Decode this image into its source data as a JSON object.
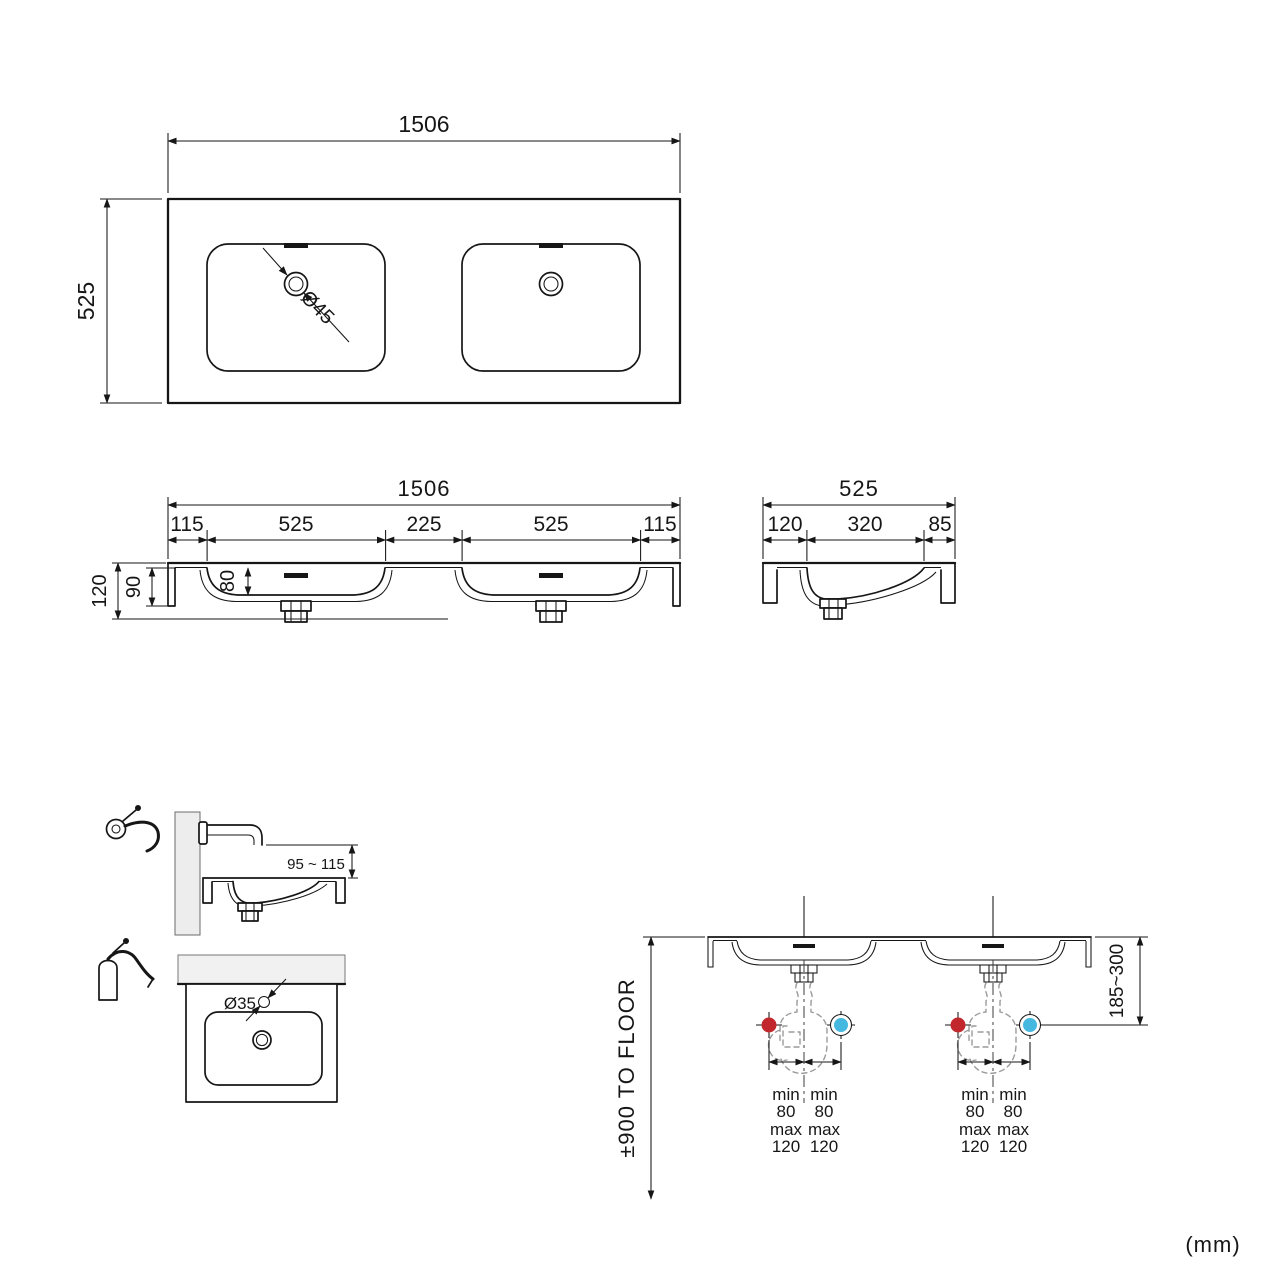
{
  "canvas": {
    "units_label": "(mm)"
  },
  "colors": {
    "hot": "#c1272d",
    "cold": "#45b8e0"
  },
  "top_view": {
    "width": "1506",
    "depth": "525",
    "drain_dia": "Ø45"
  },
  "front_view": {
    "width": "1506",
    "seg1": "115",
    "seg2": "525",
    "seg3": "225",
    "seg4": "525",
    "seg5": "115",
    "h_total": "120",
    "h_inner": "90",
    "h_basin": "80"
  },
  "side_view": {
    "width": "525",
    "seg1": "120",
    "seg2": "320",
    "seg3": "85"
  },
  "wall_tap": {
    "spout_height": "95 ~ 115"
  },
  "deck_tap": {
    "hole_dia": "Ø35"
  },
  "install": {
    "to_floor": "±900 TO FLOOR",
    "trap_range": "185~300",
    "min": "min",
    "min_v": "80",
    "max": "max",
    "max_v": "120"
  }
}
